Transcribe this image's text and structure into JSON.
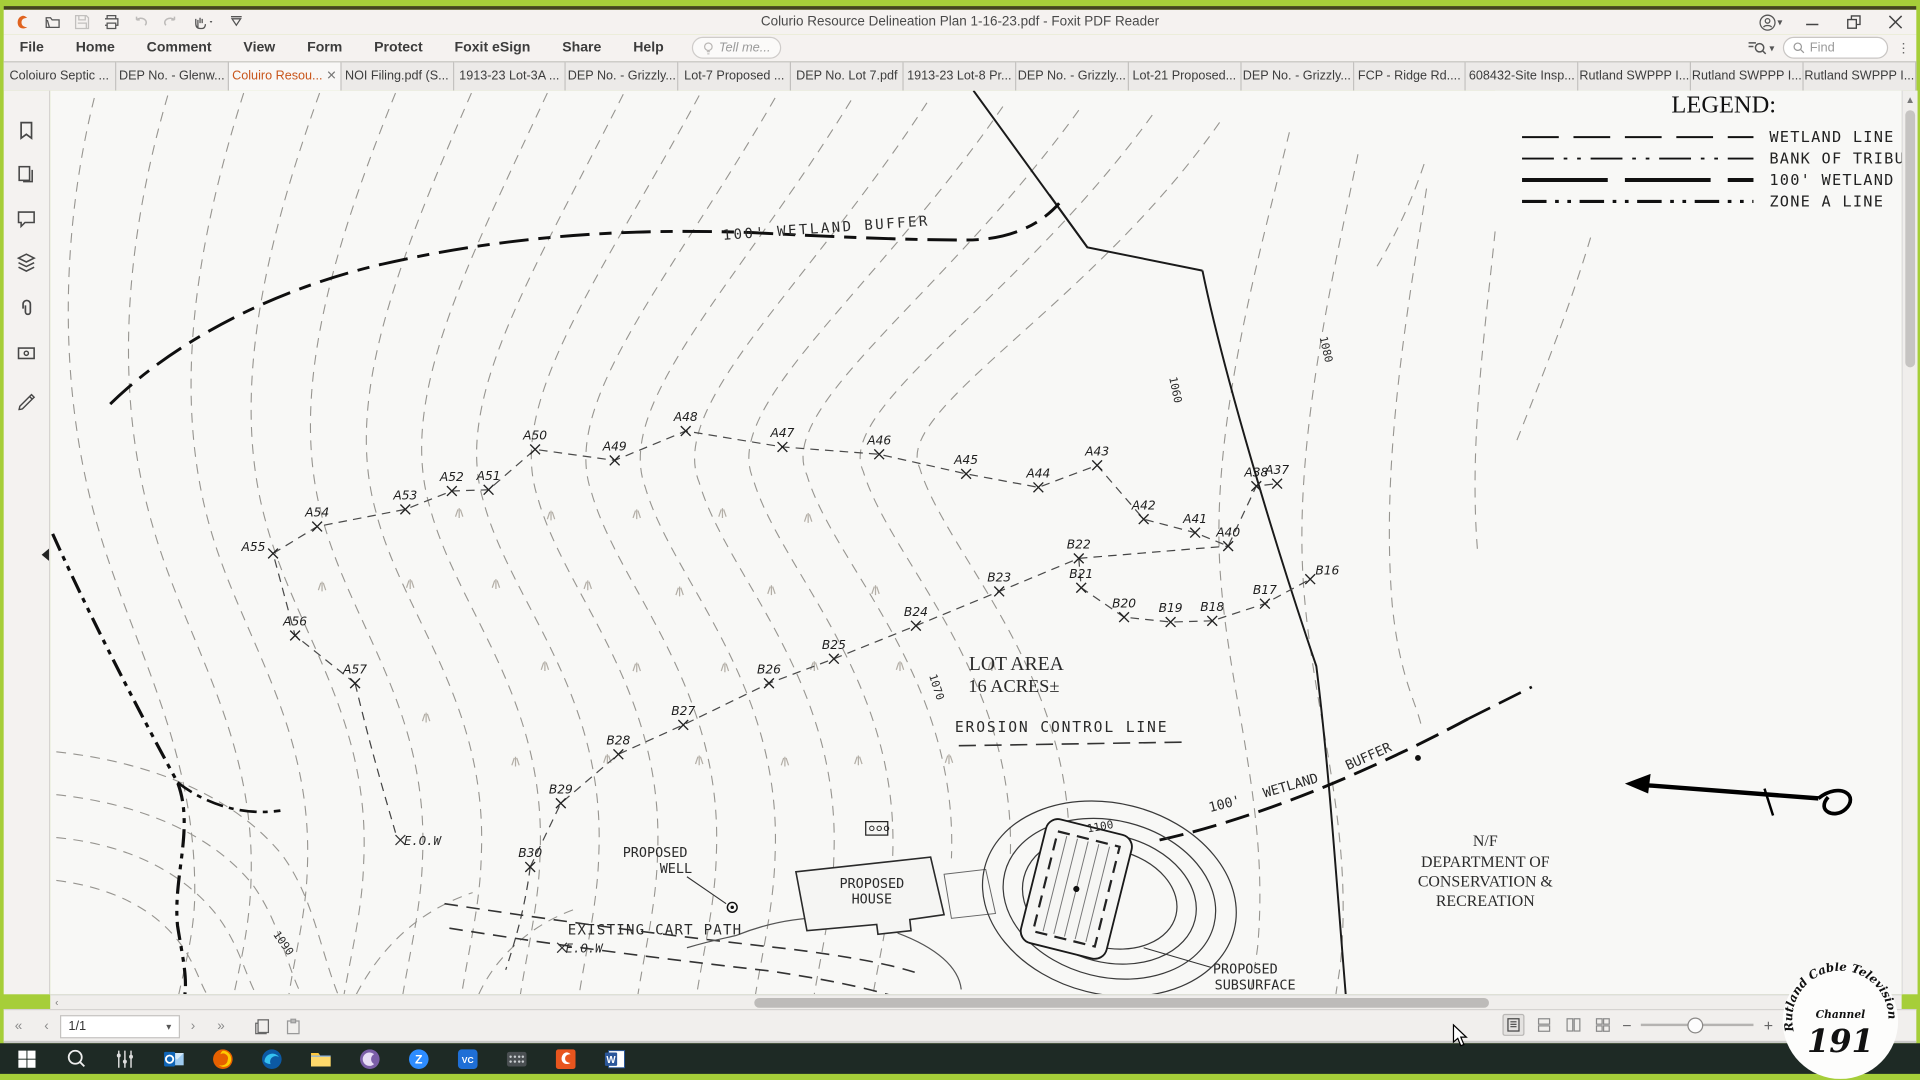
{
  "title_bar": {
    "title": "Colurio Resource Delineation Plan 1-16-23.pdf - Foxit PDF Reader"
  },
  "menu": {
    "items": [
      "File",
      "Home",
      "Comment",
      "View",
      "Form",
      "Protect",
      "Foxit eSign",
      "Share",
      "Help"
    ],
    "tell_me": "Tell me...",
    "find_placeholder": "Find"
  },
  "tabs": [
    {
      "label": "Coloiuro Septic ...",
      "active": false
    },
    {
      "label": "DEP No. - Glenw...",
      "active": false
    },
    {
      "label": "Coluiro Resou...",
      "active": true,
      "closable": true
    },
    {
      "label": "NOI Filing.pdf (S...",
      "active": false
    },
    {
      "label": "1913-23 Lot-3A ...",
      "active": false
    },
    {
      "label": "DEP No. - Grizzly...",
      "active": false
    },
    {
      "label": "Lot-7 Proposed ...",
      "active": false
    },
    {
      "label": "DEP No. Lot 7.pdf",
      "active": false
    },
    {
      "label": "1913-23 Lot-8 Pr...",
      "active": false
    },
    {
      "label": "DEP No. - Grizzly...",
      "active": false
    },
    {
      "label": "Lot-21 Proposed...",
      "active": false
    },
    {
      "label": "DEP No. - Grizzly...",
      "active": false
    },
    {
      "label": "FCP - Ridge Rd....",
      "active": false
    },
    {
      "label": "608432-Site Insp...",
      "active": false
    },
    {
      "label": "Rutland SWPPP I...",
      "active": false
    },
    {
      "label": "Rutland SWPPP I...",
      "active": false
    },
    {
      "label": "Rutland SWPPP I...",
      "active": false
    }
  ],
  "status_bar": {
    "page_indicator": "1/1"
  },
  "overlay_logo": {
    "arc_text": "Rutland Cable Television",
    "line1": "Channel",
    "line2": "191"
  },
  "map": {
    "legend": {
      "title": "LEGEND:",
      "entries": [
        {
          "label": "WETLAND LINE",
          "dash": "30 12",
          "w": 1.6
        },
        {
          "label": "BANK OF TRIBUTAR",
          "dash": "26 8 3 8 3 8",
          "w": 1.6
        },
        {
          "label": "100' WETLAND BUF",
          "dash": "70 14",
          "w": 3.2
        },
        {
          "label": "ZONE A LINE",
          "dash": "20 7 3 7 3 7",
          "w": 2.6
        }
      ]
    },
    "labels": [
      {
        "t": "100' WETLAND BUFFER",
        "x": 634,
        "y": 116,
        "r": -4,
        "s": 11.5,
        "f": "d",
        "sp": 2
      },
      {
        "t": "1080",
        "x": 1039,
        "y": 212,
        "r": 77,
        "s": 9,
        "f": "d"
      },
      {
        "t": "1060",
        "x": 916,
        "y": 245,
        "r": 78,
        "s": 9,
        "f": "d"
      },
      {
        "t": "1070",
        "x": 721,
        "y": 488,
        "r": 72,
        "s": 9,
        "f": "d"
      },
      {
        "t": "1090",
        "x": 188,
        "y": 698,
        "r": 55,
        "s": 9,
        "f": "d"
      },
      {
        "t": "1100",
        "x": 858,
        "y": 604,
        "r": -10,
        "s": 9,
        "f": "d"
      },
      {
        "t": "LOT AREA",
        "x": 789,
        "y": 473,
        "r": 0,
        "s": 16,
        "f": "serif"
      },
      {
        "t": "16 ACRES±",
        "x": 787,
        "y": 491,
        "r": 0,
        "s": 15,
        "f": "serif"
      },
      {
        "t": "EROSION CONTROL LINE",
        "x": 826,
        "y": 524,
        "r": 0,
        "s": 12,
        "f": "d",
        "sp": 1.5
      },
      {
        "t": "100'",
        "x": 960,
        "y": 586,
        "r": -14,
        "s": 11,
        "f": "d"
      },
      {
        "t": "WETLAND",
        "x": 1014,
        "y": 571,
        "r": -16,
        "s": 11,
        "f": "d"
      },
      {
        "t": "BUFFER",
        "x": 1078,
        "y": 547,
        "r": -24,
        "s": 11,
        "f": "d"
      },
      {
        "t": "N/F",
        "x": 1172,
        "y": 617,
        "r": 0,
        "s": 13,
        "f": "serif"
      },
      {
        "t": "DEPARTMENT OF",
        "x": 1172,
        "y": 634,
        "r": 0,
        "s": 13,
        "f": "serif"
      },
      {
        "t": "CONSERVATION &",
        "x": 1172,
        "y": 650,
        "r": 0,
        "s": 13,
        "f": "serif"
      },
      {
        "t": "RECREATION",
        "x": 1172,
        "y": 666,
        "r": 0,
        "s": 13,
        "f": "serif"
      },
      {
        "t": "PROPOSED",
        "x": 494,
        "y": 626,
        "r": 0,
        "s": 11,
        "f": "d"
      },
      {
        "t": "WELL",
        "x": 511,
        "y": 639,
        "r": 0,
        "s": 11,
        "f": "d"
      },
      {
        "t": "PROPOSED",
        "x": 671,
        "y": 651,
        "r": 0,
        "s": 11,
        "f": "d"
      },
      {
        "t": "HOUSE",
        "x": 671,
        "y": 664,
        "r": 0,
        "s": 11,
        "f": "d"
      },
      {
        "t": "EXISTING CART PATH",
        "x": 494,
        "y": 689,
        "r": 0,
        "s": 11.5,
        "f": "d",
        "sp": 1
      },
      {
        "t": "E.O.W",
        "x": 304,
        "y": 616,
        "r": 0,
        "s": 10,
        "f": "d",
        "i": 1
      },
      {
        "t": "E.O.W",
        "x": 436,
        "y": 704,
        "r": 0,
        "s": 10,
        "f": "d",
        "i": 1
      },
      {
        "t": "PROPOSED",
        "x": 976,
        "y": 721,
        "r": 0,
        "s": 11,
        "f": "d"
      },
      {
        "t": "SUBSURFACE",
        "x": 984,
        "y": 734,
        "r": 0,
        "s": 11,
        "f": "d"
      }
    ],
    "flags_a": [
      {
        "id": "A57",
        "x": 249,
        "y": 484
      },
      {
        "id": "A56",
        "x": 200,
        "y": 445
      },
      {
        "id": "A55",
        "x": 182,
        "y": 378,
        "dx": -16,
        "dy": -2
      },
      {
        "id": "A54",
        "x": 218,
        "y": 356
      },
      {
        "id": "A53",
        "x": 290,
        "y": 342
      },
      {
        "id": "A52",
        "x": 328,
        "y": 327
      },
      {
        "id": "A51",
        "x": 358,
        "y": 326
      },
      {
        "id": "A50",
        "x": 396,
        "y": 293
      },
      {
        "id": "A49",
        "x": 461,
        "y": 302
      },
      {
        "id": "A48",
        "x": 519,
        "y": 278
      },
      {
        "id": "A47",
        "x": 598,
        "y": 291
      },
      {
        "id": "A46",
        "x": 677,
        "y": 297
      },
      {
        "id": "A45",
        "x": 748,
        "y": 313
      },
      {
        "id": "A44",
        "x": 807,
        "y": 324
      },
      {
        "id": "A43",
        "x": 855,
        "y": 306
      },
      {
        "id": "A42",
        "x": 893,
        "y": 350
      },
      {
        "id": "A41",
        "x": 935,
        "y": 361
      },
      {
        "id": "A40",
        "x": 962,
        "y": 372
      },
      {
        "id": "A38",
        "x": 985,
        "y": 323
      },
      {
        "id": "A37",
        "x": 1002,
        "y": 321
      }
    ],
    "flags_b": [
      {
        "id": "B30",
        "x": 392,
        "y": 634
      },
      {
        "id": "B29",
        "x": 417,
        "y": 582
      },
      {
        "id": "B28",
        "x": 464,
        "y": 542
      },
      {
        "id": "B27",
        "x": 517,
        "y": 518
      },
      {
        "id": "B26",
        "x": 587,
        "y": 484
      },
      {
        "id": "B25",
        "x": 640,
        "y": 464
      },
      {
        "id": "B24",
        "x": 707,
        "y": 437
      },
      {
        "id": "B23",
        "x": 775,
        "y": 409
      },
      {
        "id": "B22",
        "x": 840,
        "y": 382
      },
      {
        "id": "B21",
        "x": 842,
        "y": 406
      },
      {
        "id": "B20",
        "x": 877,
        "y": 430
      },
      {
        "id": "B19",
        "x": 915,
        "y": 434
      },
      {
        "id": "B18",
        "x": 949,
        "y": 433
      },
      {
        "id": "B17",
        "x": 992,
        "y": 419
      },
      {
        "id": "B16",
        "x": 1029,
        "y": 399,
        "dx": 14,
        "dy": -4
      }
    ]
  }
}
